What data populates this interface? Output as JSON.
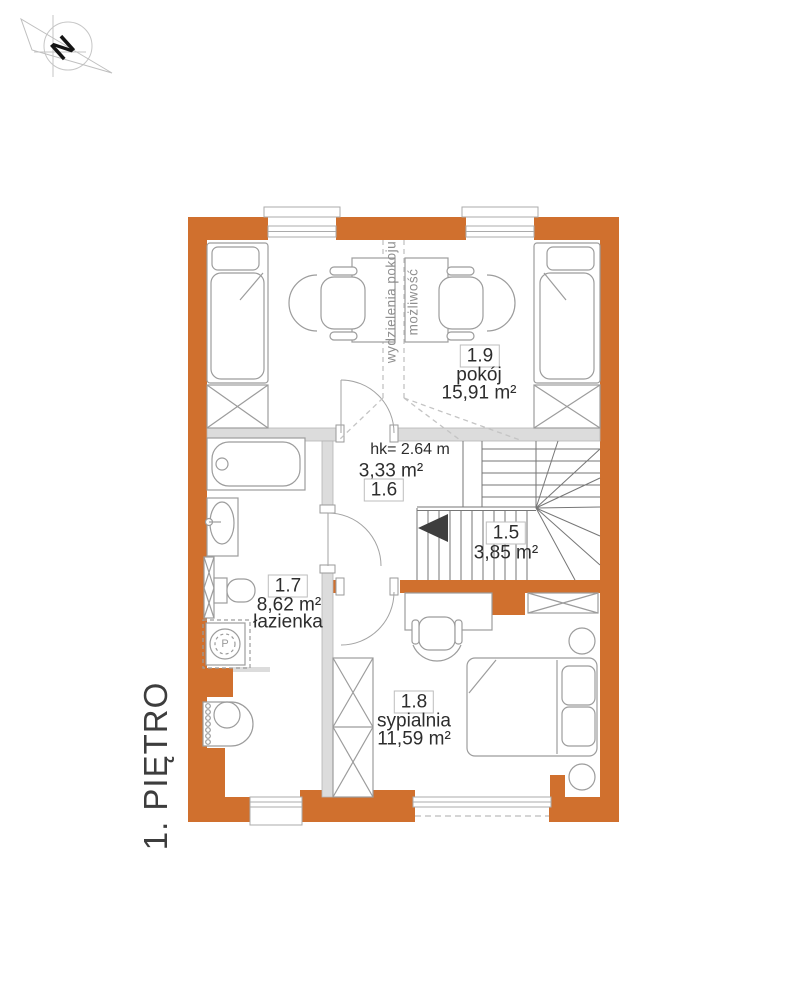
{
  "page": {
    "floor_label": "1. PIĘTRO"
  },
  "compass": {
    "north_label": "N"
  },
  "colors": {
    "wall_accent_orange": "#D0702E",
    "interior_wall_gray": "#DCDCDC",
    "furniture_line_gray": "#9C9C9C",
    "stair_line_gray": "#767676",
    "text_dark": "#2D2D2D",
    "muted_text_gray": "#8F8F8F"
  },
  "partition_note": {
    "right_line": "możliwość",
    "left_line": "wydzielenia pokoju"
  },
  "rooms": {
    "stairs": {
      "number": "1.5",
      "area": "3,85 m²"
    },
    "hall": {
      "number": "1.6",
      "area": "3,33 m²",
      "height_note": "hk= 2.64 m"
    },
    "bathroom": {
      "number": "1.7",
      "area": "8,62 m²",
      "name": "łazienka"
    },
    "bedroom": {
      "number": "1.8",
      "area": "11,59 m²",
      "name": "sypialnia"
    },
    "room": {
      "number": "1.9",
      "area": "15,91 m²",
      "name": "pokój"
    }
  },
  "appliances": {
    "washer_label": "P"
  }
}
